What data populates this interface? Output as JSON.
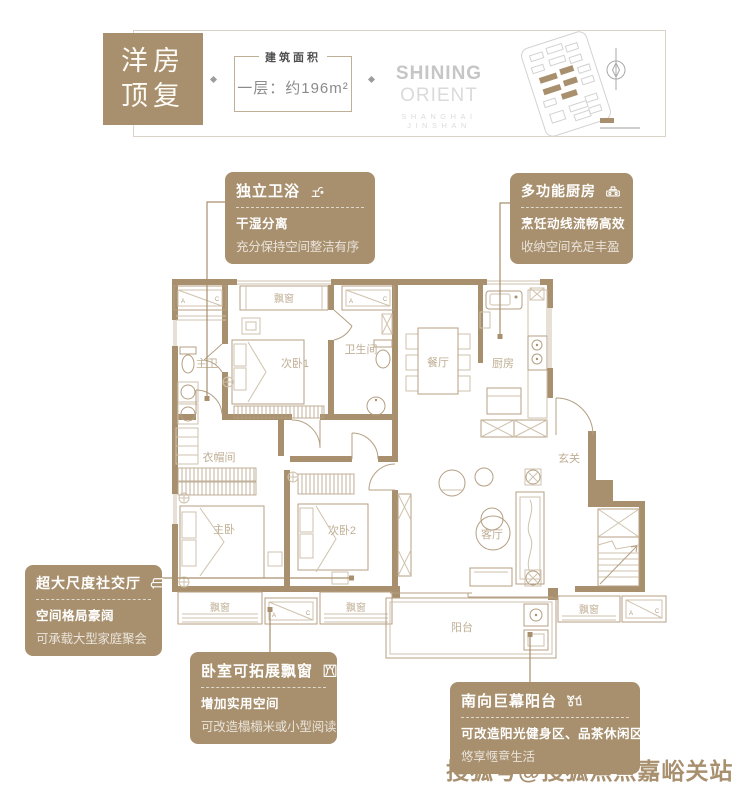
{
  "header": {
    "badge_line1": "洋房",
    "badge_line2": "顶复",
    "area_label": "建筑面积",
    "area_value": "一层：约196m²",
    "brand_bold": "SHINING",
    "brand_light": "ORIENT",
    "brand_sub": "SHANGHAI JINSHAN",
    "icons": {
      "compass": "compass-north-icon",
      "sitemap": "estate-sitemap"
    }
  },
  "callouts": {
    "bath": {
      "title": "独立卫浴",
      "icon": "faucet-icon",
      "line1": "干湿分离",
      "line2": "充分保持空间整洁有序"
    },
    "kitchen": {
      "title": "多功能厨房",
      "icon": "stove-icon",
      "line1": "烹饪动线流畅高效",
      "line2": "收纳空间充足丰盈"
    },
    "social": {
      "title": "超大尺度社交厅",
      "icon": "sofa-icon",
      "line1": "空间格局豪阔",
      "line2": "可承载大型家庭聚会"
    },
    "baywin": {
      "title": "卧室可拓展飘窗",
      "icon": "bay-window-icon",
      "line1": "增加实用空间",
      "line2": "可改造榻榻米或小型阅读角"
    },
    "balcony": {
      "title": "南向巨幕阳台",
      "icon": "plant-icon",
      "line1": "可改造阳光健身区、品茶休闲区",
      "line2": "悠享惬意生活"
    }
  },
  "floorplan": {
    "rooms": {
      "master_bath": "主卫",
      "bedroom1": "次卧1",
      "bathroom": "卫生间",
      "dining": "餐厅",
      "kitchen": "厨房",
      "cloakroom": "衣帽间",
      "foyer": "玄关",
      "master_bedroom": "主卧",
      "bedroom2": "次卧2",
      "living": "客厅",
      "balcony": "阳台"
    },
    "bay_window": "飘窗",
    "ac": {
      "a": "A",
      "c": "C"
    }
  },
  "watermark": "搜狐号@搜狐焦点嘉峪关站",
  "colors": {
    "tan": "#a8906e",
    "plan_line": "#b49f83",
    "plan_light_line": "#cfc2ac",
    "plan_label": "#bfae94",
    "frame_gray": "#d9d3c8",
    "brand_gray": "#c6c6c6"
  }
}
